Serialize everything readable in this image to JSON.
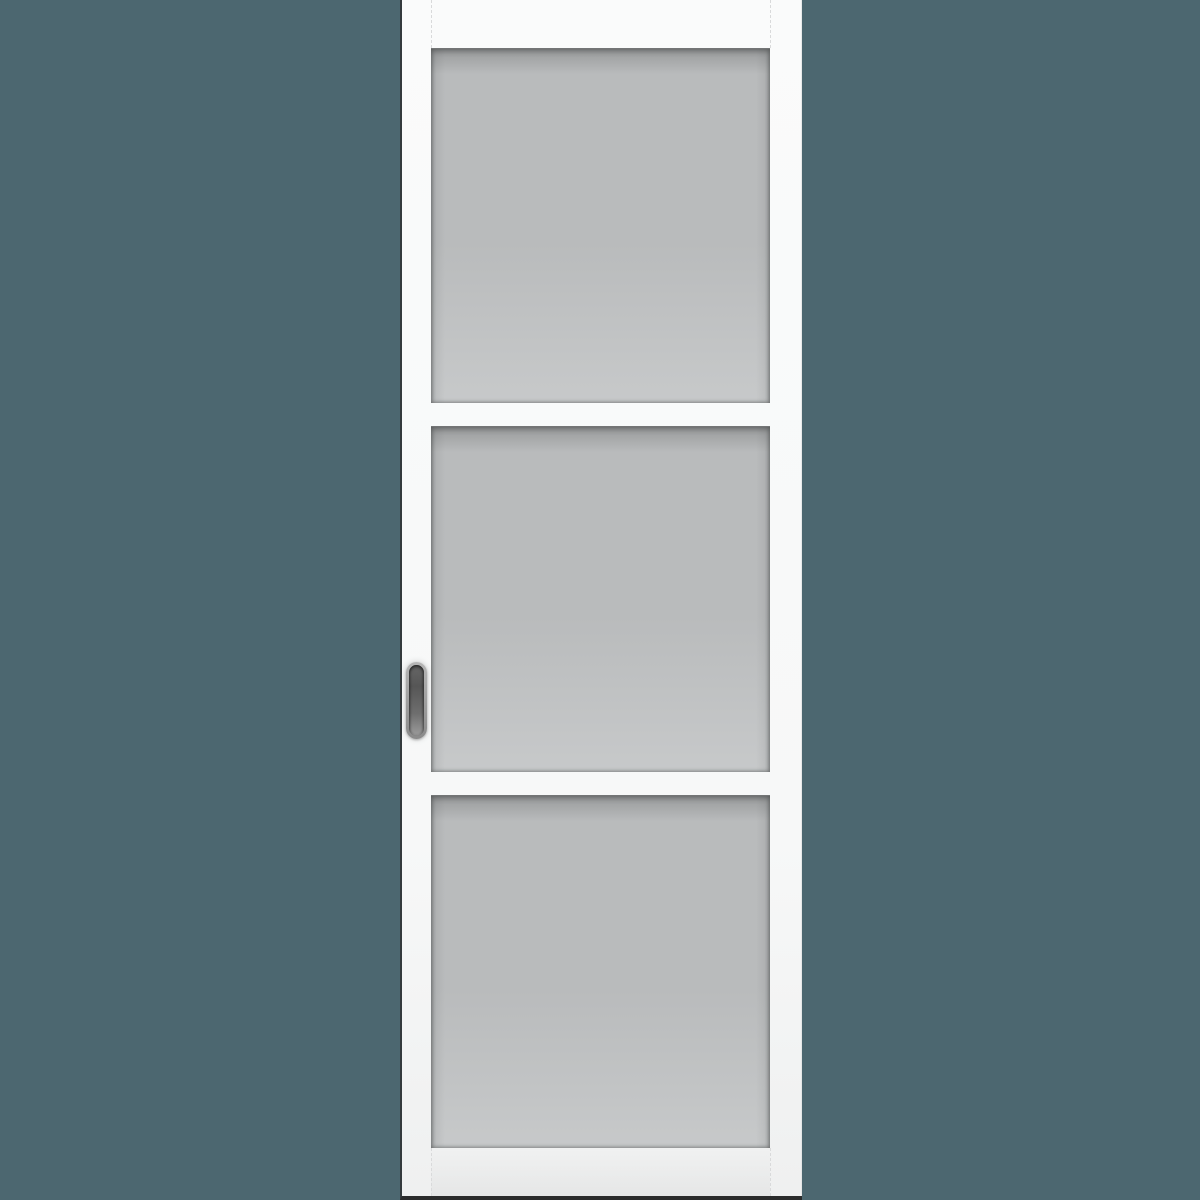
{
  "meta": {
    "type": "product-image",
    "subject": "White sliding pocket door with three frosted glass panels",
    "backdrop": "solid teal studio background",
    "panel_count": 3
  },
  "labels": {
    "stage": "teal product backdrop",
    "door": "white sliding door with 3 frosted glass lites",
    "glass_top": "top frosted glass panel",
    "glass_middle": "middle frosted glass panel",
    "glass_bottom": "bottom frosted glass panel",
    "handle": "recessed oval metal pull handle",
    "top_rail": "door top rail",
    "mid_rail_1": "door middle rail between top and middle panels",
    "mid_rail_2": "door middle rail between middle and bottom panels",
    "bottom_rail": "door bottom rail",
    "left_stile": "door left stile",
    "right_stile": "door right stile"
  },
  "colors": {
    "background": "#4c6770",
    "door_white": "#fafbfb",
    "door_white_dim": "#eff0f0",
    "door_left_edge": "#343a3d",
    "door_bottom_edge": "#2b2c2c",
    "joint_line": "#d9dadb",
    "glass_top": "#97999a",
    "glass_base": "#b9bbbc",
    "glass_bottom": "#c7c9ca",
    "glass_edge_line": "#737576",
    "handle_rim_light": "#b6b6b6",
    "handle_rim_dark": "#8a8a8a",
    "handle_recess_dark": "#565656",
    "handle_recess_light": "#9c9c9c"
  }
}
